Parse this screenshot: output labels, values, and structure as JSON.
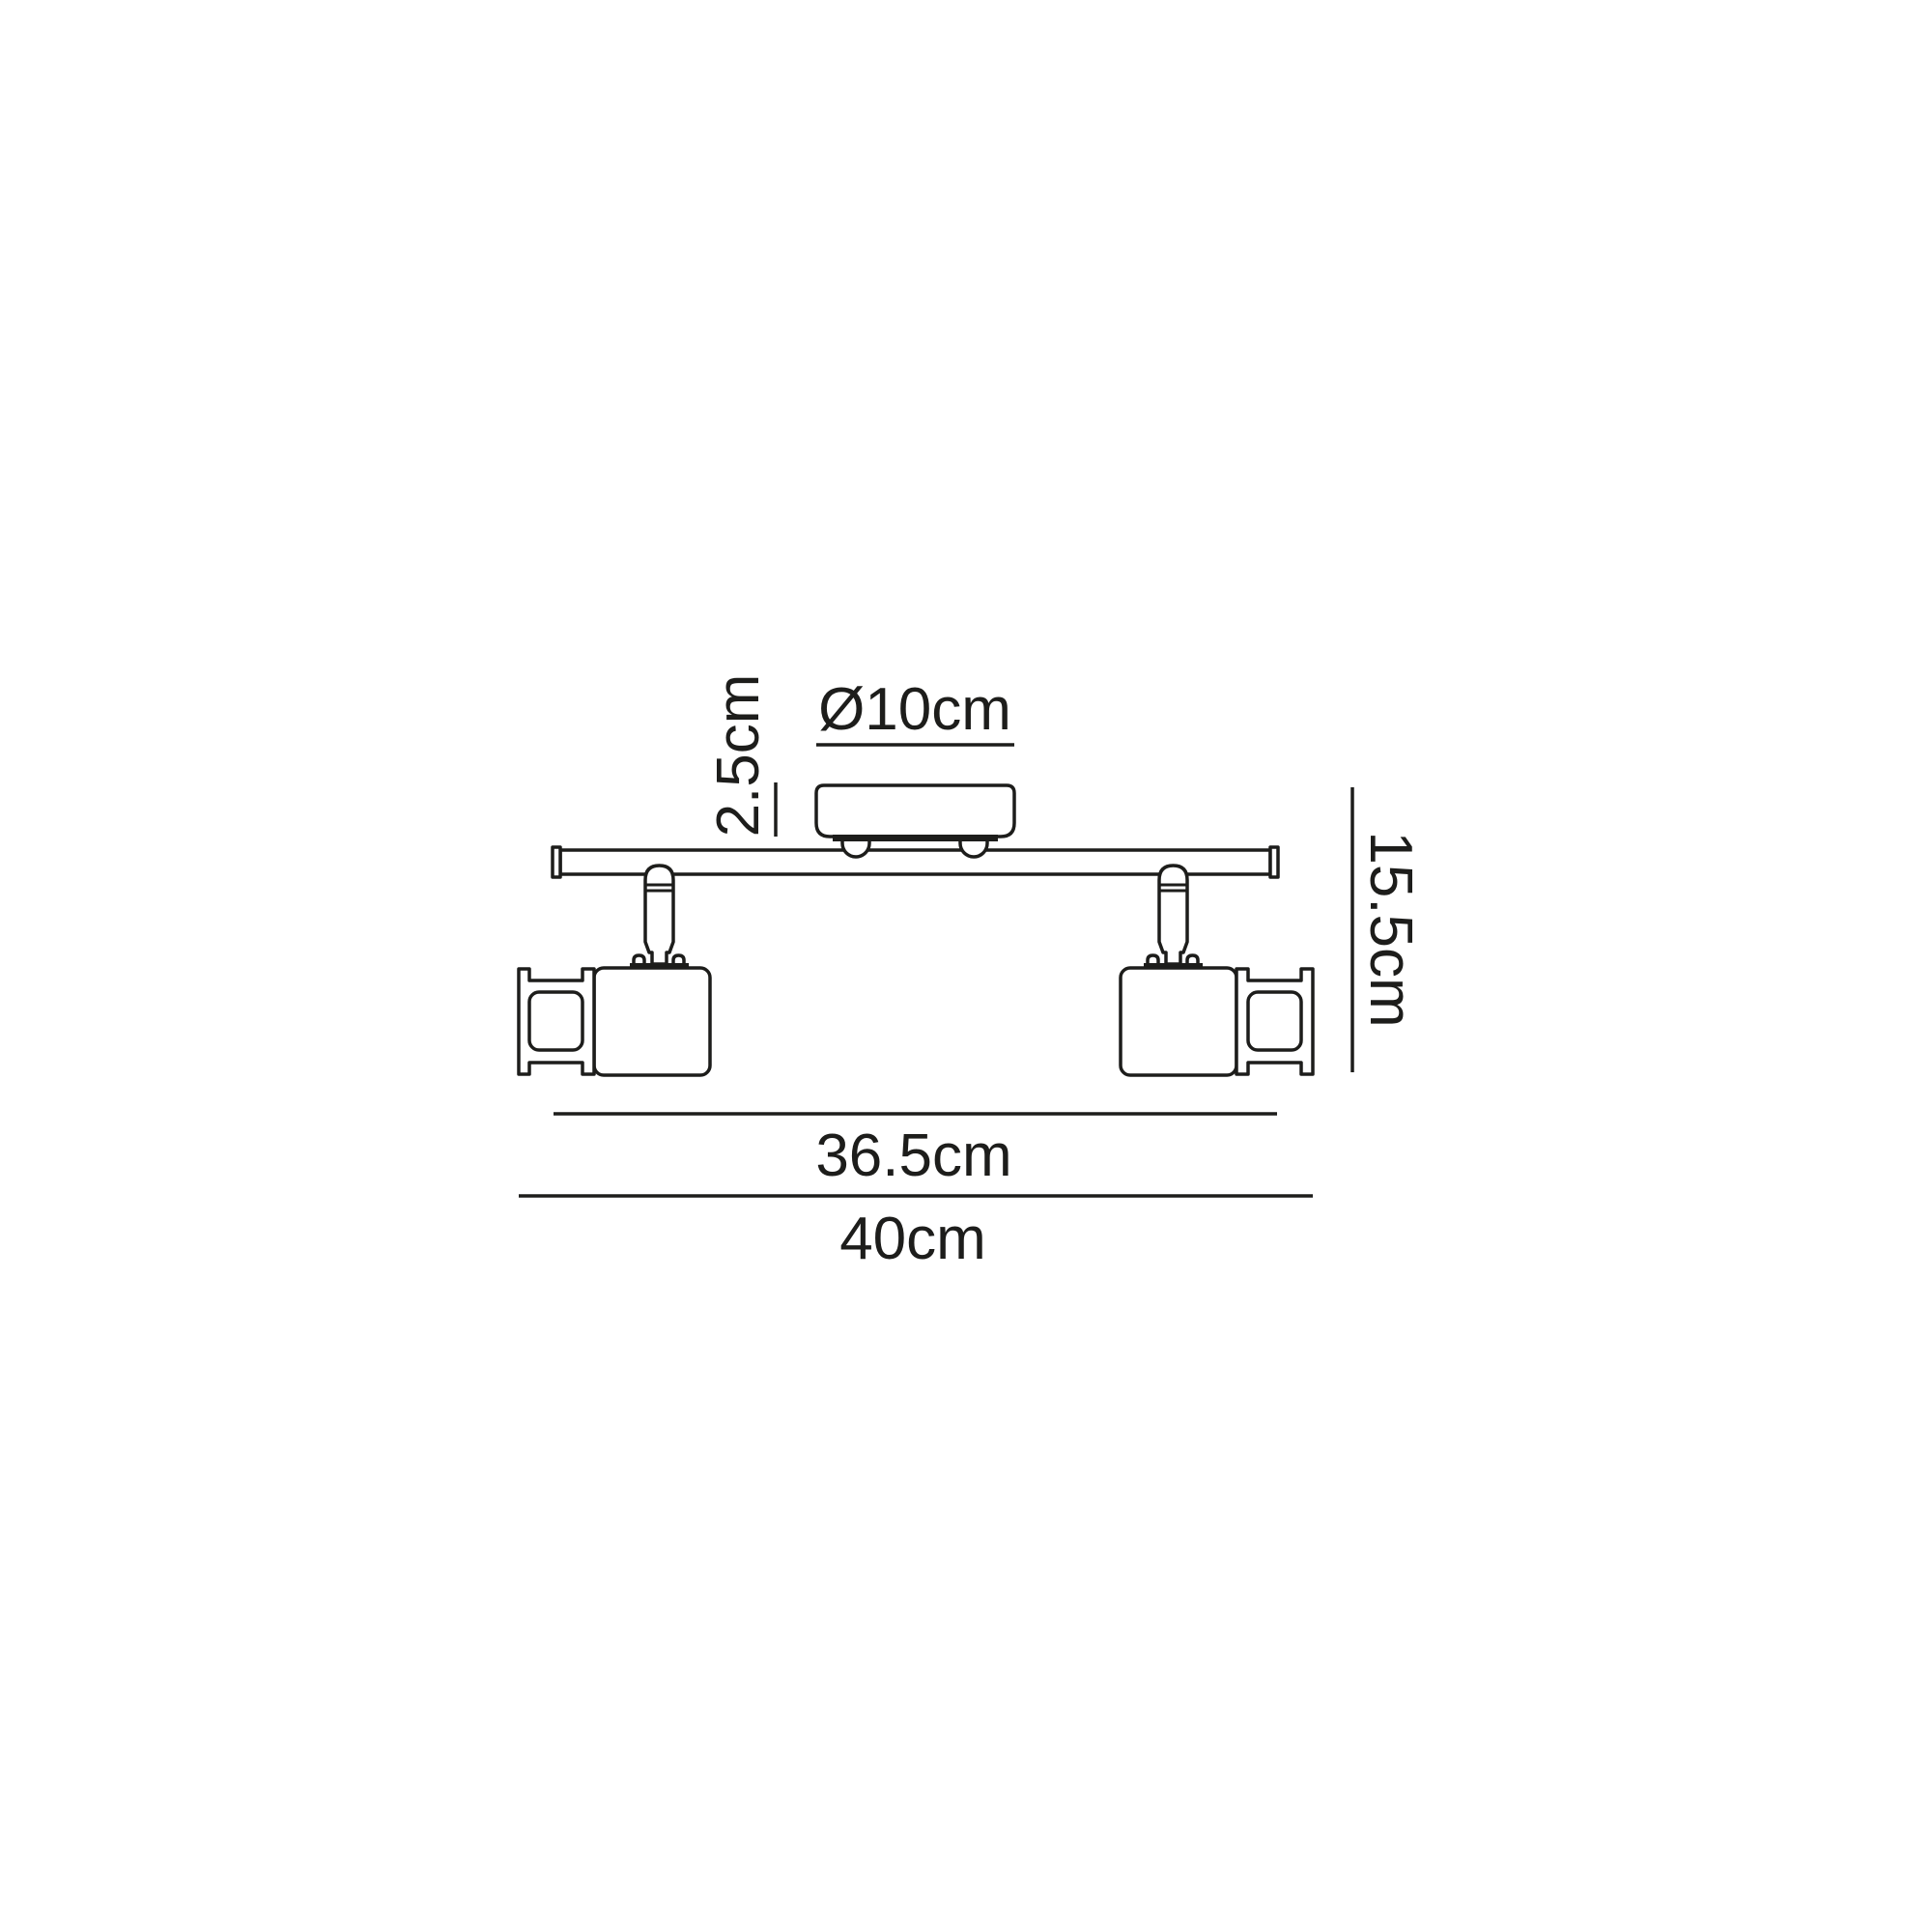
{
  "figure": {
    "type": "technical-dimension-diagram",
    "subject": "two-head adjustable ceiling spotlight bar, side elevation",
    "labels": {
      "canopy_diameter": "Ø10cm",
      "canopy_height": "2.5cm",
      "fixture_height": "15.5cm",
      "bar_length": "36.5cm",
      "overall_width": "40cm"
    },
    "colors": {
      "line": "#1d1d1b",
      "background": "#ffffff",
      "text": "#1d1d1b"
    }
  }
}
